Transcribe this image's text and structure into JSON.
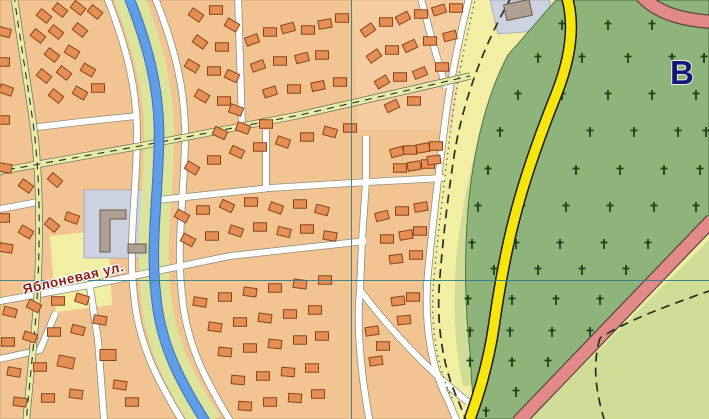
{
  "map": {
    "street_label": "Яблоневая ул.",
    "area_letter": "В",
    "palette": {
      "open_land": "#f2efa4",
      "settlement": "#f2c492",
      "settlement_tint": "#f6d0a6",
      "building_fill": "#e68f55",
      "building_stroke": "#8a431d",
      "road_fill": "#ffffff",
      "road_casing": "#8f8f80",
      "unpaved_fill": "#e6eba6",
      "unpaved_casing": "#6b6b5a",
      "unpaved_dash": "#2b2b2b",
      "stream_fill": "#5f9de6",
      "stream_casing": "#3a6fc0",
      "stream_bank": "#dce49c",
      "cemetery_green": "#8eb47c",
      "cemetery_edge": "#4a6a3a",
      "cross_color": "#1c4418",
      "light_green": "#cfdd96",
      "light_green2": "#dfe6a8",
      "yellow_road": "#f7e50e",
      "yellow_casing": "#1c1c1c",
      "pink_road": "#e28a8a",
      "pink_casing": "#5a4a42",
      "trail_color": "#2c2c1e",
      "grid_color": "#2f7d8e",
      "label_color": "#8c1b12",
      "letter_color": "#16167a",
      "plot_fill": "#ccd2e0",
      "plot_stroke": "#9aa2b8",
      "plot_building_fill": "#b0a093",
      "plot_building_stroke": "#6b5a4a"
    },
    "grid": {
      "vertical_x": 351.5,
      "horizontal_y": 280.5
    },
    "shapes": {
      "settlement": "M0,0 L470,0 C456,50 448,95 444,130 C438,180 431,235 427,285 C425,330 432,370 448,400 L458,419 L0,419 Z",
      "settlement_tint": "M352,0 L468,0 L452,130 L358,130 Z",
      "cemetery": "M556,0 L709,0 L709,222 L565,372 L520,419 L474,419 L470,352 C465,310 464,258 468,208 C473,155 484,100 508,55 Z",
      "light_green_tri": "M709,240 L709,419 L530,419 Z",
      "light_green_patch": "M495,419 C510,392 532,378 560,376 L522,419 Z",
      "pale_patch": "M50,236 L108,230 L112,305 L56,312 Z",
      "plot1": "M84,190 L164,190 L164,258 L84,258 Z",
      "plot1_building": "M100,210 L126,210 L126,219 L110,219 L110,252 L100,252 Z",
      "plot1_building2": {
        "x": 128,
        "y": 244,
        "w": 18,
        "h": 9
      },
      "plot2": "M490,0 L550,0 L550,30 L498,34 Z",
      "plot2_building": {
        "x": 505,
        "y": 2,
        "w": 26,
        "h": 16,
        "angle": -12
      },
      "light_green_band": "M500,105 C480,150 470,200 464,250 C460,295 460,340 470,385",
      "stream": "M128,-5 C148,45 160,90 159,140 C158,200 150,245 156,295 C160,345 182,385 207,424",
      "yellow_road": "M566,-6 C576,25 570,60 556,95 C540,135 524,180 514,220 C505,255 499,290 494,325 C489,360 480,392 468,424",
      "pink_road_top": "M640,-6 C655,12 680,20 714,22",
      "pink_road_bottom": "M712,220 L518,422",
      "boundary_dots": "M476,-4 C462,55 454,100 450,135 C444,185 437,240 433,290 C431,332 438,372 454,402"
    },
    "white_roads": [
      "M106,-5 C126,45 138,90 137,140 C136,200 128,245 134,295 C138,345 160,385 184,424",
      "M154,-5 C174,45 186,90 185,140 C184,200 176,245 182,295 C186,345 208,385 232,424",
      "M-5,302 L95,284 L230,256 L366,241",
      "M158,200 L270,188 L368,182 L444,178",
      "M366,136 L366,182 L362,240 L360,290",
      "M360,290 C356,330 362,380 370,424",
      "M360,290 C390,330 430,372 468,402",
      "M470,-6 C456,50 448,95 444,130 C438,180 431,235 427,285 C425,330 432,370 448,400 L458,424",
      "M30,128 L80,122 L136,116",
      "M420,-5 L432,40 L446,88",
      "M266,130 L266,188",
      "M90,287 L98,340 L104,419",
      "M238,-5 L240,60 L242,128",
      "M-5,210 L38,202",
      "M-5,360 L40,350 L56,312"
    ],
    "unpaved_roads": [
      "M-5,172 L140,146 L300,115 L470,76",
      "M14,-5 C20,40 28,85 34,130 C40,180 40,230 38,280 C36,330 30,375 26,424"
    ],
    "trails": [
      "M512,-4 C478,55 462,110 455,150 C448,195 442,245 439,290 C437,330 444,370 458,400 L466,420",
      "M712,290 C660,308 625,322 600,338",
      "M600,338 C592,365 596,392 604,419"
    ],
    "crosses": [
      [
        562,
        25
      ],
      [
        608,
        25
      ],
      [
        652,
        25
      ],
      [
        538,
        58
      ],
      [
        582,
        58
      ],
      [
        628,
        58
      ],
      [
        672,
        58
      ],
      [
        704,
        58
      ],
      [
        518,
        95
      ],
      [
        562,
        95
      ],
      [
        608,
        95
      ],
      [
        652,
        95
      ],
      [
        696,
        95
      ],
      [
        500,
        132
      ],
      [
        545,
        132
      ],
      [
        590,
        132
      ],
      [
        634,
        132
      ],
      [
        678,
        132
      ],
      [
        706,
        132
      ],
      [
        488,
        170
      ],
      [
        532,
        170
      ],
      [
        576,
        170
      ],
      [
        620,
        170
      ],
      [
        664,
        170
      ],
      [
        700,
        170
      ],
      [
        478,
        207
      ],
      [
        522,
        207
      ],
      [
        566,
        207
      ],
      [
        610,
        207
      ],
      [
        654,
        207
      ],
      [
        696,
        207
      ],
      [
        472,
        244
      ],
      [
        516,
        244
      ],
      [
        560,
        244
      ],
      [
        604,
        244
      ],
      [
        648,
        244
      ],
      [
        688,
        244
      ],
      [
        494,
        270
      ],
      [
        538,
        270
      ],
      [
        582,
        270
      ],
      [
        626,
        270
      ],
      [
        668,
        270
      ],
      [
        468,
        300
      ],
      [
        512,
        300
      ],
      [
        556,
        300
      ],
      [
        600,
        300
      ],
      [
        470,
        332
      ],
      [
        510,
        332
      ],
      [
        552,
        332
      ],
      [
        590,
        332
      ],
      [
        470,
        362
      ],
      [
        512,
        362
      ],
      [
        548,
        362
      ],
      [
        478,
        392
      ],
      [
        516,
        392
      ],
      [
        486,
        412
      ]
    ],
    "buildings": [
      [
        44,
        16,
        38
      ],
      [
        60,
        10,
        38
      ],
      [
        78,
        8,
        38
      ],
      [
        95,
        12,
        38
      ],
      [
        38,
        36,
        38
      ],
      [
        56,
        32,
        38
      ],
      [
        80,
        30,
        38
      ],
      [
        52,
        55,
        38
      ],
      [
        72,
        52,
        30
      ],
      [
        44,
        76,
        38
      ],
      [
        64,
        73,
        38
      ],
      [
        88,
        70,
        30
      ],
      [
        56,
        96,
        38
      ],
      [
        80,
        93,
        30
      ],
      [
        98,
        88,
        0
      ],
      [
        4,
        32,
        15
      ],
      [
        3,
        62,
        0
      ],
      [
        6,
        90,
        20
      ],
      [
        3,
        120,
        0
      ],
      [
        5,
        168,
        10
      ],
      [
        3,
        218,
        0
      ],
      [
        6,
        248,
        10
      ],
      [
        26,
        186,
        35
      ],
      [
        55,
        180,
        40
      ],
      [
        26,
        232,
        30
      ],
      [
        52,
        225,
        40
      ],
      [
        72,
        218,
        20
      ],
      [
        196,
        15,
        35
      ],
      [
        216,
        10,
        0
      ],
      [
        232,
        25,
        30
      ],
      [
        200,
        42,
        35
      ],
      [
        222,
        47,
        0
      ],
      [
        192,
        66,
        30
      ],
      [
        214,
        71,
        0
      ],
      [
        232,
        76,
        25
      ],
      [
        202,
        96,
        30
      ],
      [
        224,
        101,
        0
      ],
      [
        236,
        110,
        20
      ],
      [
        252,
        40,
        -20
      ],
      [
        270,
        32,
        0
      ],
      [
        288,
        28,
        -15
      ],
      [
        308,
        30,
        0
      ],
      [
        325,
        24,
        -10
      ],
      [
        342,
        18,
        0
      ],
      [
        258,
        66,
        -20
      ],
      [
        280,
        61,
        0
      ],
      [
        302,
        58,
        -15
      ],
      [
        322,
        55,
        0
      ],
      [
        270,
        92,
        -18
      ],
      [
        294,
        89,
        0
      ],
      [
        318,
        86,
        -12
      ],
      [
        340,
        82,
        0
      ],
      [
        368,
        30,
        -35
      ],
      [
        386,
        22,
        0
      ],
      [
        403,
        18,
        -28
      ],
      [
        421,
        14,
        0
      ],
      [
        439,
        10,
        -18
      ],
      [
        456,
        8,
        0
      ],
      [
        374,
        56,
        -35
      ],
      [
        392,
        50,
        0
      ],
      [
        410,
        46,
        -26
      ],
      [
        430,
        41,
        0
      ],
      [
        450,
        36,
        -14
      ],
      [
        382,
        82,
        -30
      ],
      [
        400,
        77,
        0
      ],
      [
        420,
        73,
        -22
      ],
      [
        442,
        67,
        0
      ],
      [
        392,
        106,
        -26
      ],
      [
        414,
        101,
        0
      ],
      [
        192,
        168,
        30
      ],
      [
        214,
        160,
        0
      ],
      [
        237,
        152,
        25
      ],
      [
        260,
        147,
        0
      ],
      [
        283,
        142,
        20
      ],
      [
        307,
        137,
        0
      ],
      [
        330,
        132,
        15
      ],
      [
        350,
        128,
        0
      ],
      [
        243,
        128,
        20
      ],
      [
        266,
        124,
        0
      ],
      [
        220,
        133,
        25
      ],
      [
        397,
        152,
        -15
      ],
      [
        410,
        150,
        0
      ],
      [
        423,
        148,
        -10
      ],
      [
        436,
        146,
        0
      ],
      [
        400,
        168,
        0
      ],
      [
        414,
        166,
        -10
      ],
      [
        428,
        164,
        0
      ],
      [
        434,
        160,
        -8
      ],
      [
        182,
        216,
        30
      ],
      [
        203,
        210,
        0
      ],
      [
        227,
        206,
        25
      ],
      [
        251,
        202,
        0
      ],
      [
        276,
        208,
        20
      ],
      [
        300,
        204,
        0
      ],
      [
        322,
        210,
        15
      ],
      [
        188,
        240,
        28
      ],
      [
        212,
        236,
        0
      ],
      [
        236,
        231,
        18
      ],
      [
        260,
        227,
        0
      ],
      [
        284,
        232,
        14
      ],
      [
        307,
        229,
        0
      ],
      [
        330,
        236,
        10
      ],
      [
        382,
        216,
        -14
      ],
      [
        402,
        211,
        0
      ],
      [
        421,
        207,
        -10
      ],
      [
        387,
        239,
        0
      ],
      [
        406,
        235,
        -10
      ],
      [
        420,
        231,
        0
      ],
      [
        396,
        259,
        -8
      ],
      [
        416,
        255,
        0
      ],
      [
        10,
        312,
        14
      ],
      [
        34,
        306,
        28
      ],
      [
        58,
        301,
        0
      ],
      [
        82,
        299,
        18
      ],
      [
        8,
        342,
        0
      ],
      [
        30,
        337,
        18
      ],
      [
        54,
        332,
        0
      ],
      [
        78,
        330,
        14
      ],
      [
        14,
        372,
        10
      ],
      [
        40,
        367,
        0
      ],
      [
        66,
        362,
        12,
        16,
        11
      ],
      [
        20,
        402,
        8
      ],
      [
        48,
        398,
        0
      ],
      [
        76,
        394,
        8
      ],
      [
        100,
        320,
        10
      ],
      [
        108,
        355,
        0,
        16,
        11
      ],
      [
        120,
        385,
        8
      ],
      [
        132,
        402,
        0
      ],
      [
        200,
        302,
        10
      ],
      [
        225,
        297,
        0
      ],
      [
        250,
        292,
        8
      ],
      [
        275,
        288,
        0
      ],
      [
        300,
        284,
        8
      ],
      [
        325,
        280,
        0
      ],
      [
        215,
        327,
        8
      ],
      [
        240,
        322,
        0
      ],
      [
        265,
        318,
        8
      ],
      [
        290,
        314,
        0
      ],
      [
        315,
        310,
        0
      ],
      [
        225,
        352,
        6
      ],
      [
        250,
        348,
        0
      ],
      [
        275,
        344,
        6
      ],
      [
        300,
        340,
        0
      ],
      [
        322,
        336,
        0
      ],
      [
        238,
        380,
        5
      ],
      [
        263,
        376,
        0
      ],
      [
        288,
        372,
        5
      ],
      [
        312,
        368,
        0
      ],
      [
        245,
        406,
        4
      ],
      [
        270,
        402,
        0
      ],
      [
        295,
        398,
        4
      ],
      [
        318,
        394,
        0
      ],
      [
        372,
        331,
        -9
      ],
      [
        383,
        346,
        0
      ],
      [
        376,
        361,
        -7
      ],
      [
        398,
        301,
        -8
      ],
      [
        413,
        297,
        0
      ],
      [
        404,
        320,
        -6
      ]
    ]
  }
}
